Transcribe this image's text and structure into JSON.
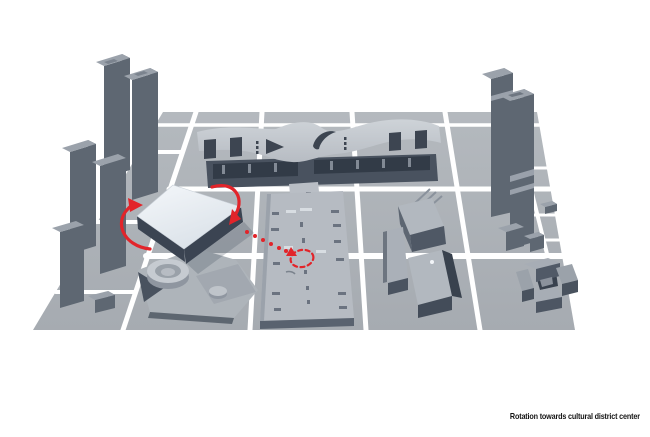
{
  "window": {
    "width": 650,
    "height": 437
  },
  "caption": {
    "text": "Rotation towards cultural district center"
  },
  "colors": {
    "background": "#ffffff",
    "road": "#ffffff",
    "ground": "#a6abb1",
    "ground_far": "#b4b9be",
    "roof_light": "#b2b8bf",
    "side_dark": "#4d5663",
    "tower_face": "#5e6772",
    "tower_side": "#414a57",
    "tower_roof": "#9ba2ab",
    "hall_roof": "#c5cad0",
    "opening_dark": "#3d4551",
    "highlight_top": "#f4f7fa",
    "highlight_top_deep": "#dbe2e9",
    "highlight_side": "#3b4452",
    "accent": "#e2242a",
    "caption_text": "#141414"
  },
  "scene": {
    "type": "axonometric-massing-diagram",
    "elements": [
      {
        "name": "ground-plane",
        "role": "site plan with white road grid"
      },
      {
        "name": "left-towers",
        "role": "row of five high-rise slabs"
      },
      {
        "name": "exhibition-hall",
        "role": "long wave-roof building at top"
      },
      {
        "name": "right-towers",
        "role": "pair of tall towers"
      },
      {
        "name": "podium-slab-building",
        "role": "long flat podium block in center"
      },
      {
        "name": "rotated-cube-building",
        "role": "highlighted white volume being rotated"
      },
      {
        "name": "angular-cluster-buildings",
        "role": "faceted mid-rise group"
      },
      {
        "name": "courtyard-building",
        "role": "pinwheel block around courtyard"
      },
      {
        "name": "drum-building",
        "role": "low wedge building with circular drum"
      }
    ]
  },
  "annotations": {
    "rotation_arrow_left": "counterclockwise arc",
    "rotation_arrow_right": "clockwise arc",
    "trajectory": "dotted arrow toward district center",
    "target": "dashed circle"
  }
}
